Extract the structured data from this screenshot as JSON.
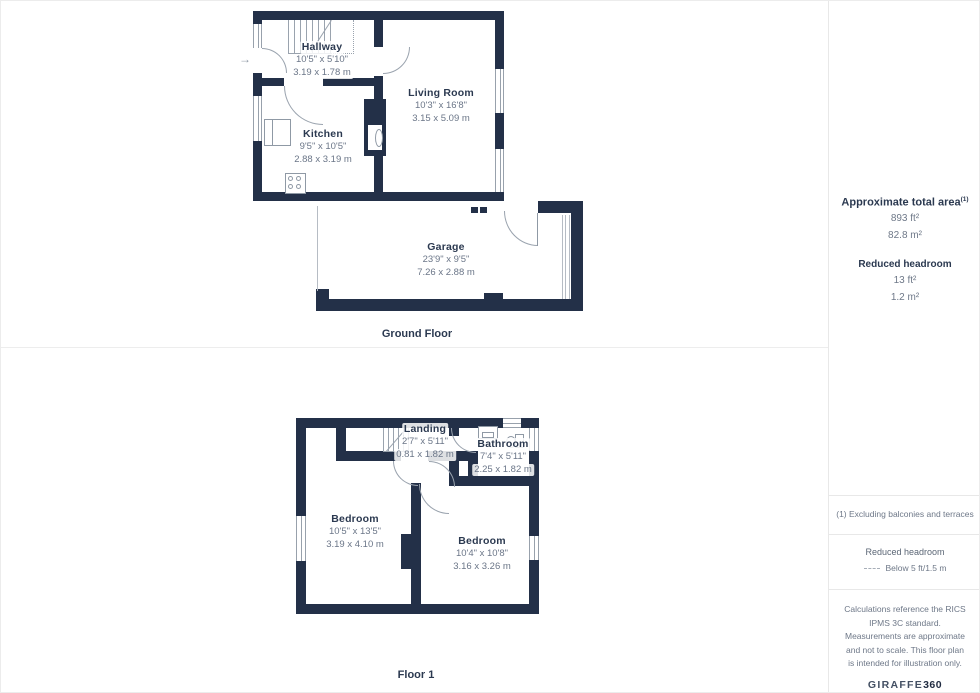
{
  "floors": [
    {
      "name": "Ground Floor",
      "rooms": [
        {
          "name": "Hallway",
          "imperial": "10'5\" x 5'10\"",
          "metric": "3.19 x 1.78 m"
        },
        {
          "name": "Kitchen",
          "imperial": "9'5\" x 10'5\"",
          "metric": "2.88 x 3.19 m"
        },
        {
          "name": "Living Room",
          "imperial": "10'3\" x 16'8\"",
          "metric": "3.15 x 5.09 m"
        },
        {
          "name": "Garage",
          "imperial": "23'9\" x 9'5\"",
          "metric": "7.26 x 2.88 m"
        }
      ]
    },
    {
      "name": "Floor 1",
      "rooms": [
        {
          "name": "Landing",
          "imperial": "2'7\" x 5'11\"",
          "metric": "0.81 x 1.82 m"
        },
        {
          "name": "Bathroom",
          "imperial": "7'4\" x 5'11\"",
          "metric": "2.25 x 1.82 m"
        },
        {
          "name": "Bedroom",
          "imperial": "10'5\" x 13'5\"",
          "metric": "3.19 x 4.10 m"
        },
        {
          "name": "Bedroom",
          "imperial": "10'4\" x 10'8\"",
          "metric": "3.16 x 3.26 m"
        }
      ]
    }
  ],
  "icons": {
    "entry_arrow": "→"
  },
  "sidebar": {
    "total_area_label": "Approximate total area",
    "total_area_footnote_marker": "(1)",
    "total_area_ft": "893 ft²",
    "total_area_m": "82.8 m²",
    "reduced_headroom_label": "Reduced headroom",
    "reduced_headroom_ft": "13 ft²",
    "reduced_headroom_m": "1.2 m²",
    "note_1": "(1) Excluding balconies and terraces",
    "legend_title": "Reduced headroom",
    "legend_value": "Below 5 ft/1.5 m",
    "disclaimer": "Calculations reference the RICS IPMS 3C standard. Measurements are approximate and not to scale. This floor plan is intended for illustration only.",
    "brand": {
      "name": "GIRAFFE",
      "suffix": "360"
    }
  },
  "colors": {
    "wall": "#233048",
    "room_name_text": "#2b3950",
    "dimension_text": "#6b7688",
    "line": "#9aa3ae"
  }
}
